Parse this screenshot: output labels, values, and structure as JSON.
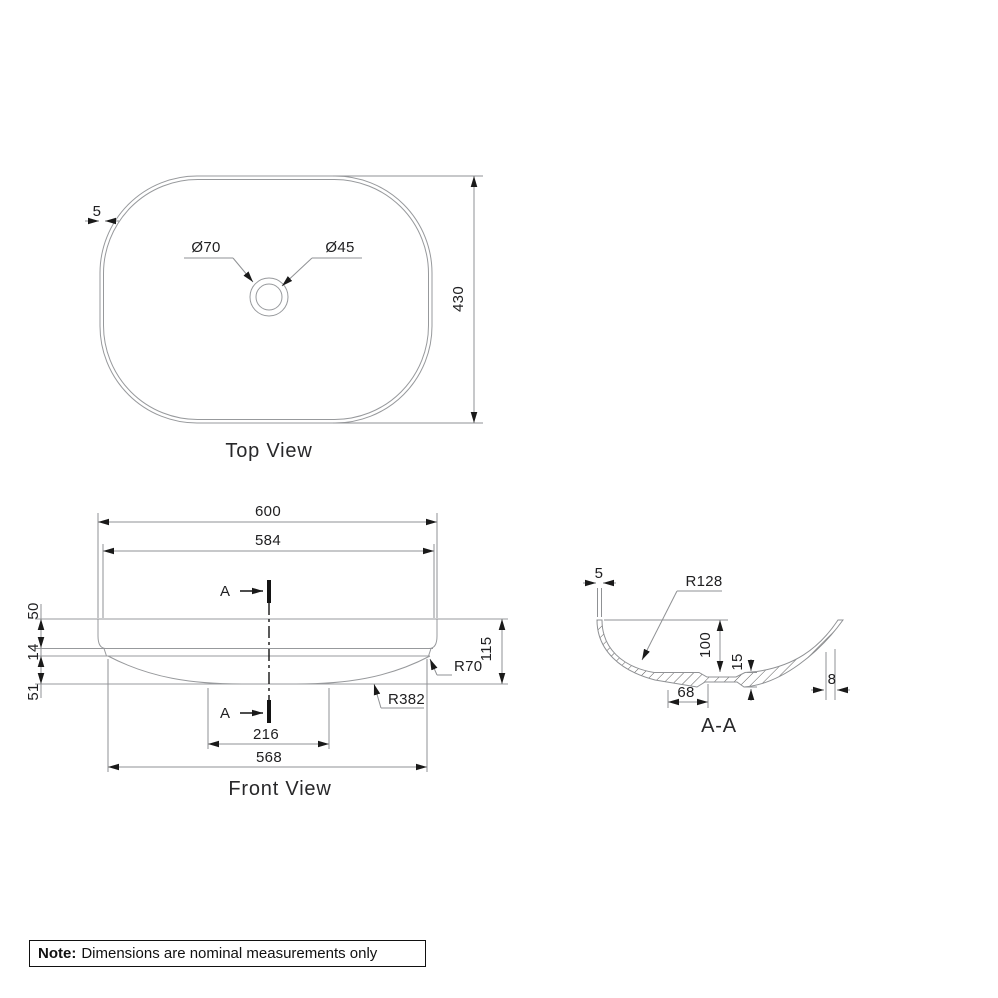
{
  "drawing": {
    "top_view": {
      "title": "Top View",
      "rim_thickness": "5",
      "length_dim": "430",
      "drain_outer_dia": "Ø70",
      "drain_inner_dia": "Ø45"
    },
    "front_view": {
      "title": "Front View",
      "overall_width": "600",
      "rim_inner_width": "584",
      "upper_height": "50",
      "mid_height": "14",
      "lower_height": "51",
      "overall_height": "115",
      "corner_radius": "R70",
      "base_radius": "R382",
      "base_flat_width": "216",
      "base_width": "568",
      "section_letter": "A"
    },
    "section_view": {
      "title": "A-A",
      "wall_thickness": "5",
      "inner_radius": "R128",
      "inner_depth": "100",
      "base_thickness": "15",
      "drain_flat_width": "68",
      "wall_edge_thickness": "8"
    },
    "note": {
      "prefix": "Note:",
      "text": "Dimensions are nominal measurements only"
    }
  }
}
